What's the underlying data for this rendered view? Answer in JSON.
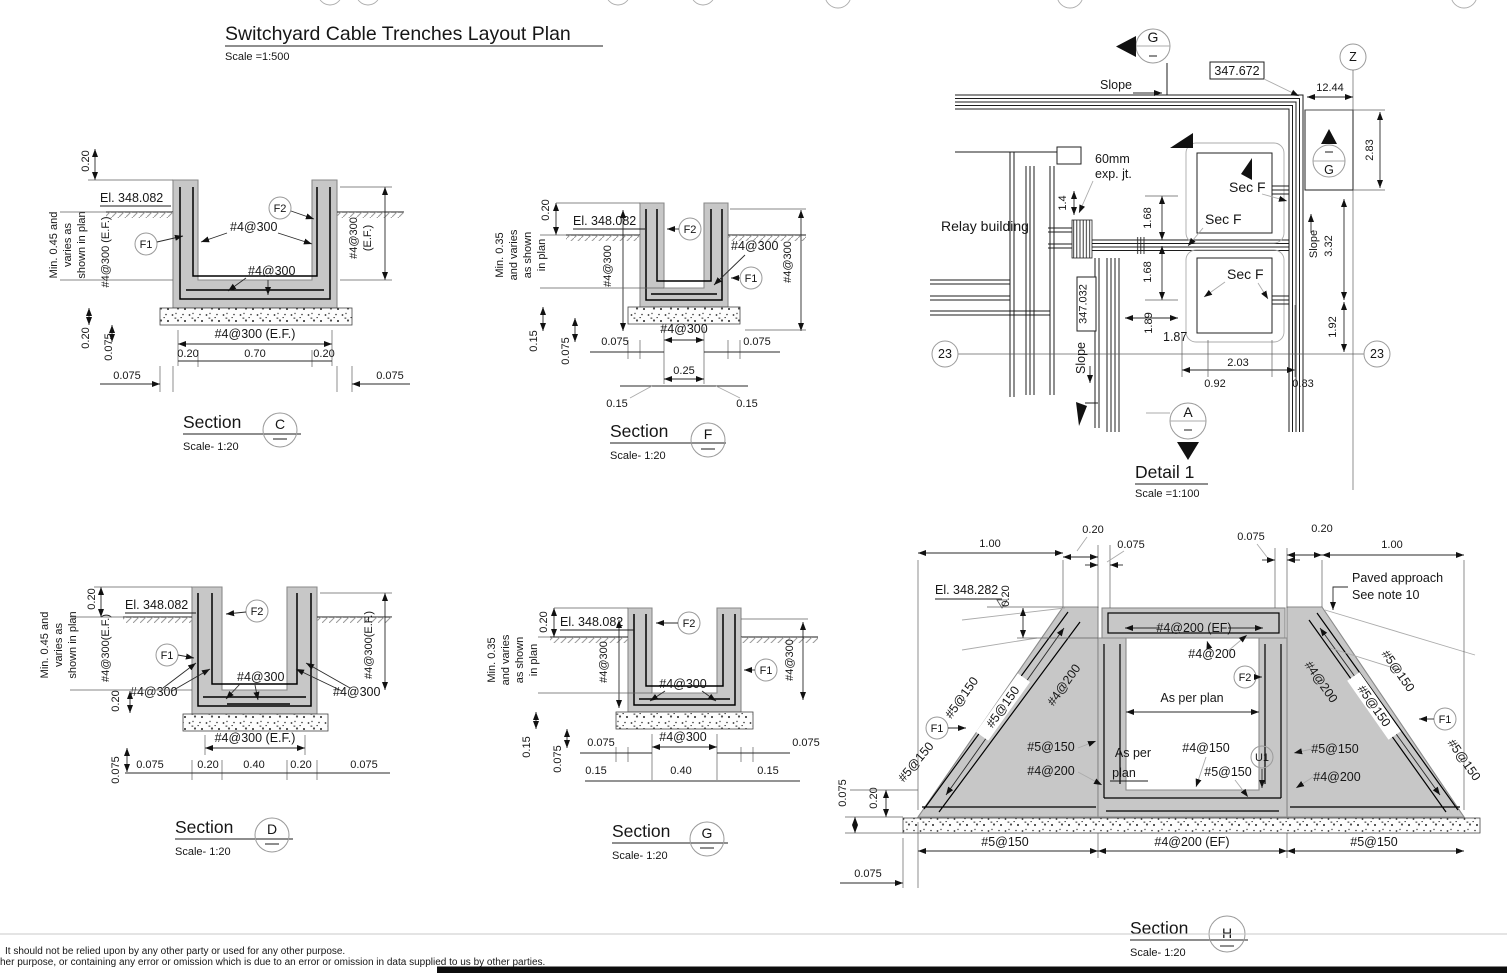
{
  "doc": {
    "title": "Switchyard Cable Trenches Layout Plan",
    "title_scale": "Scale =1:500",
    "footer_line1": "It should not be relied upon by any other party or used for any other purpose.",
    "footer_line2": "her purpose, or containing any error or omission which is due to an error or omission in data supplied to us by other parties."
  },
  "t": {
    "section": "Section",
    "scale120": "Scale- 1:20",
    "c": "C",
    "d": "D",
    "f": "F",
    "g": "G",
    "h": "H",
    "r4300": "#4@300",
    "r4300_ef": "#4@300 (E.F.)",
    "r4300ef": "#4@300(E.F.)",
    "ef_paren": "(E.F.)",
    "r4200": "#4@200",
    "r4200_ef": "#4@200 (EF)",
    "r4150": "#4@150",
    "r5150": "#5@150",
    "f1": "F1",
    "f2": "F2",
    "u1": "U1",
    "el_348_082": "El. 348.082",
    "el_348_282": "El. 348.282",
    "min045": "Min. 0.45 and",
    "varies_as": "varies as",
    "shown_in_plan": "shown in plan",
    "min035": "Min. 0.35",
    "and_varies": "and varies",
    "as_shown": "as shown",
    "in_plan": "in plan",
    "d020": "0.20",
    "d070": "0.70",
    "d0075": "0.075",
    "d025": "0.25",
    "d015": "0.15",
    "d040": "0.40",
    "d100": "1.00",
    "as_per": "As per",
    "plan": "plan",
    "as_per_plan": "As per plan",
    "paved1": "Paved approach",
    "paved2": "See note 10"
  },
  "plan": {
    "title": "Detail 1",
    "scale": "Scale =1:100",
    "relay": "Relay building",
    "slope": "Slope",
    "sec_f": "Sec F",
    "exp1": "60mm",
    "exp2": "exp. jt.",
    "el_347_672": "347.672",
    "el_347_032": "347.032",
    "z": "Z",
    "g": "G",
    "a": "A",
    "grid23": "23",
    "d1244": "12.44",
    "d283": "2.83",
    "d332": "3.32",
    "d192": "1.92",
    "d14": "1.4",
    "d168": "1.68",
    "d189": "1.89",
    "d187": "1.87",
    "d203": "2.03",
    "d092": "0.92",
    "d083": "0.83"
  }
}
